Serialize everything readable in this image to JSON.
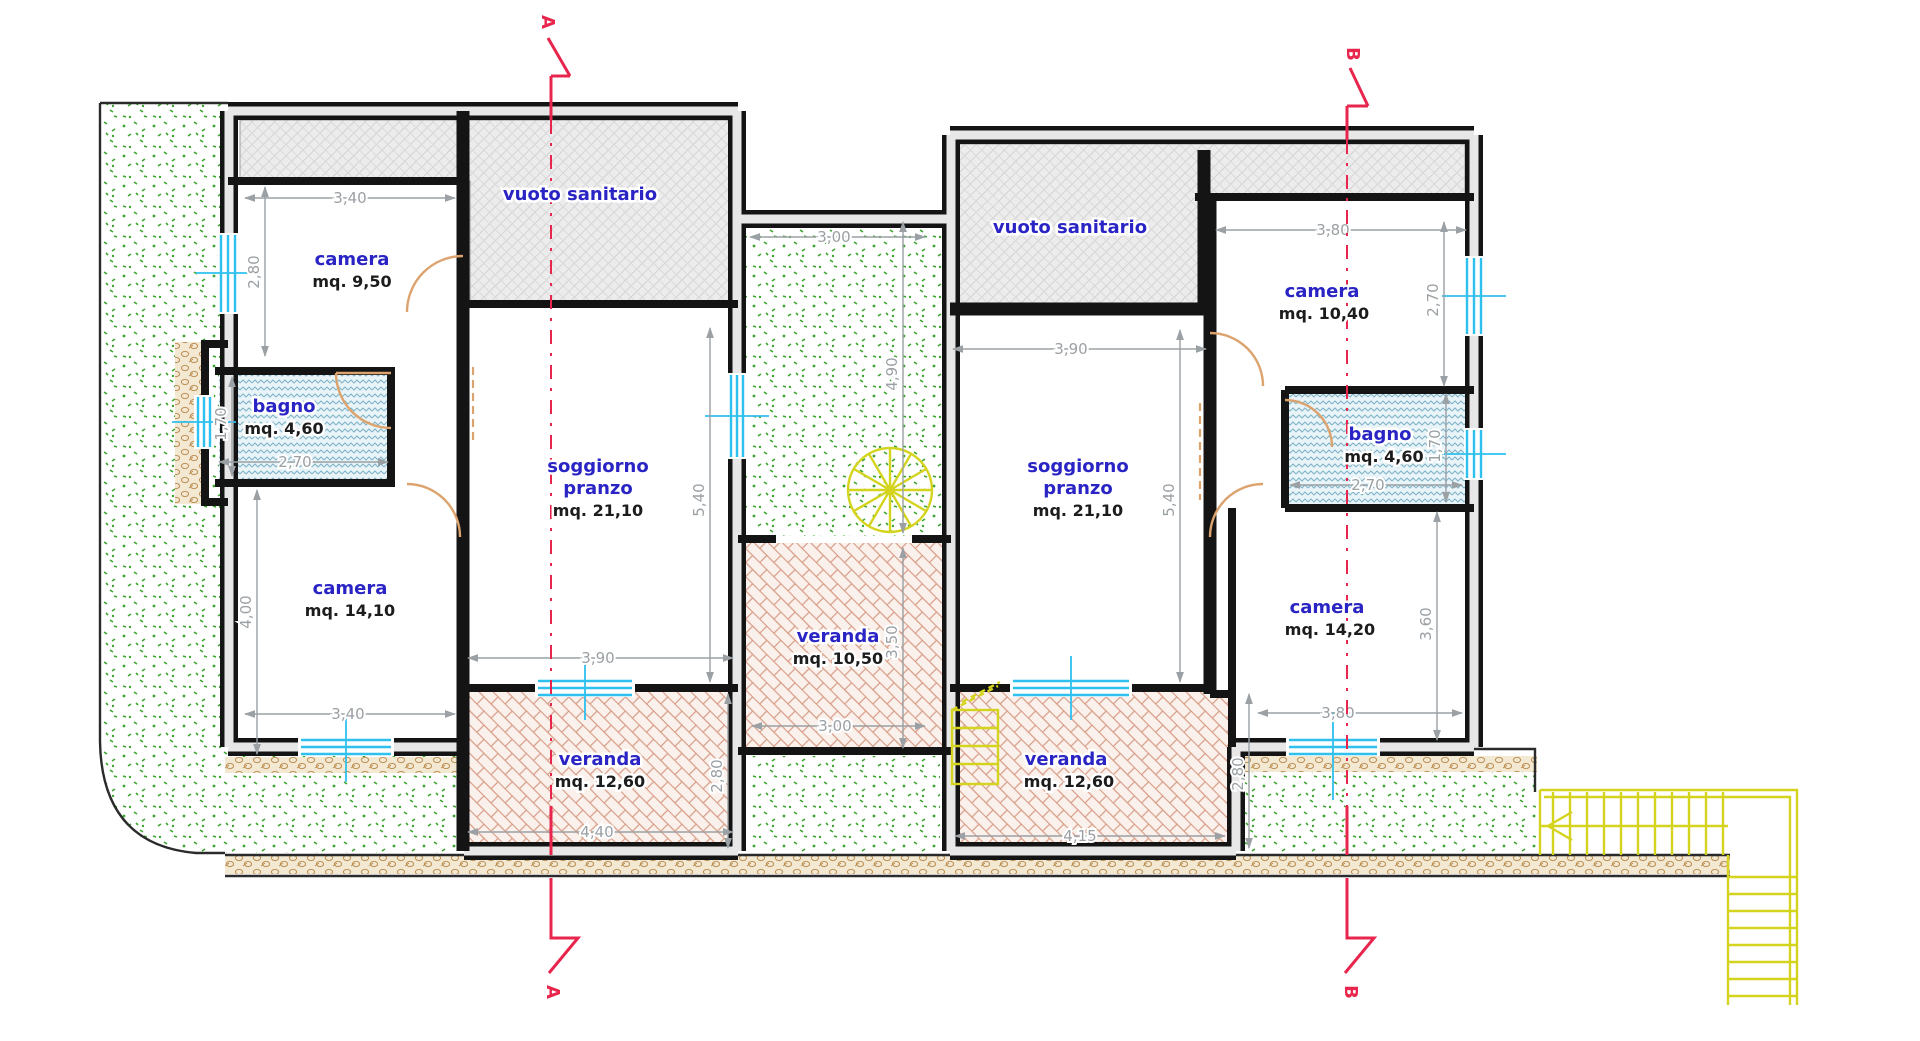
{
  "drawing": {
    "kind": "floor-plan",
    "rooms": {
      "left_vuoto": {
        "name": "vuoto sanitario"
      },
      "left_camera_1": {
        "name": "camera",
        "area": "mq. 9,50"
      },
      "left_bagno": {
        "name": "bagno",
        "area": "mq. 4,60"
      },
      "left_camera_2": {
        "name": "camera",
        "area": "mq. 14,10"
      },
      "left_soggiorno": {
        "line1": "soggiorno",
        "line2": "pranzo",
        "area": "mq. 21,10"
      },
      "left_veranda": {
        "name": "veranda",
        "area": "mq. 12,60"
      },
      "center_veranda": {
        "name": "veranda",
        "area": "mq. 10,50"
      },
      "right_vuoto": {
        "name": "vuoto sanitario"
      },
      "right_camera_1": {
        "name": "camera",
        "area": "mq. 10,40"
      },
      "right_bagno": {
        "name": "bagno",
        "area": "mq. 4,60"
      },
      "right_soggiorno": {
        "line1": "soggiorno",
        "line2": "pranzo",
        "area": "mq. 21,10"
      },
      "right_camera_2": {
        "name": "camera",
        "area": "mq. 14,20"
      },
      "right_veranda": {
        "name": "veranda",
        "area": "mq. 12,60"
      }
    },
    "dimensions": {
      "left_camera1_width": "3,40",
      "left_camera1_height": "2,80",
      "left_bagno_height": "1,70",
      "left_bagno_width": "2,70",
      "left_camera2_height": "4,00",
      "left_camera2_width": "3,40",
      "left_soggiorno_width": "3,90",
      "left_soggiorno_height": "5,40",
      "left_veranda_width": "4,40",
      "left_veranda_height": "2,80",
      "court_width": "3,00",
      "court_height": "4,90",
      "center_veranda_height": "3,50",
      "center_veranda_width": "3,00",
      "right_soggiorno_width": "3,90",
      "right_soggiorno_height": "5,40",
      "right_camera1_width": "3,80",
      "right_camera1_height": "2,70",
      "right_bagno_height": "1,70",
      "right_bagno_width": "2,70",
      "right_camera2_height": "3,60",
      "right_camera2_width": "3,80",
      "right_veranda_width": "4,15",
      "right_veranda_height": "2,80"
    },
    "sections": {
      "a": "A",
      "b": "B"
    },
    "colors": {
      "wall": "#141414",
      "window": "#2ec0ee",
      "door": "#dca36e",
      "dimension": "#9aa0a4",
      "room_label": "#2a24c4",
      "area_label": "#1c1c1c",
      "section_marker": "#e8254c",
      "stairs": "#d4d41f",
      "garden_dots": "#3ba52e",
      "veranda_hatch": "#d79c86",
      "bagno_hatch": "#7fb3c8",
      "vuoto_hatch": "#c6c6c6",
      "foundation_hatch": "#bd9055"
    }
  }
}
